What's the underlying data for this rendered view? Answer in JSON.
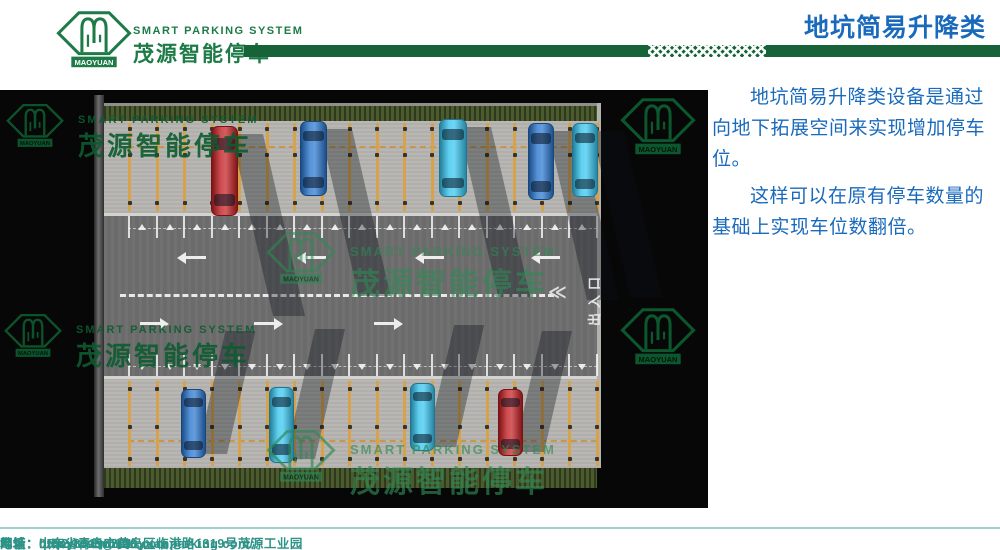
{
  "header": {
    "brand_logo_text": "MAOYUAN",
    "brand_en": "SMART PARKING SYSTEM",
    "brand_cn": "茂源智能停车",
    "title": "地坑简易升降类"
  },
  "colors": {
    "brand_green": "#1e7b48",
    "bar_green": "#166339",
    "title_blue": "#1a6abc",
    "footer_teal": "#2e9387",
    "watermark_on_black": "#0d5c31",
    "watermark_on_road": "#2e8a55"
  },
  "main": {
    "paragraphs": [
      "地坑简易升降类设备是通过向地下拓展空间来实现增加停车位。",
      "这样可以在原有停车数量的基础上实现车位数翻倍。"
    ]
  },
  "diagram": {
    "watermark_text": {
      "en": "SMART PARKING SYSTEM",
      "cn": "茂源智能停车",
      "brand": "MAOYUAN"
    },
    "exit": {
      "label": "出入口",
      "chevrons": "≪"
    },
    "slots": {
      "x_start": 128,
      "x_step": 27.5,
      "count": 18,
      "top_y": 33,
      "top_h": 88,
      "bottom_y": 291,
      "bottom_h": 85
    },
    "t_marks": {
      "top_line_y": 126,
      "bottom_line_y": 264,
      "line_h": 22,
      "top_rail_y": 138,
      "bottom_rail_y": 276
    },
    "arrows": {
      "top_y": 166,
      "bottom_y": 232,
      "top_dir": "left",
      "bottom_dir": "right",
      "top_x": [
        186,
        306,
        424,
        540
      ],
      "bottom_x": [
        140,
        254,
        374
      ]
    },
    "cars": [
      {
        "row": "top",
        "x": 211,
        "y": 36,
        "w": 27,
        "h": 90,
        "color": "#c32024"
      },
      {
        "row": "top",
        "x": 300,
        "y": 31,
        "w": 27,
        "h": 75,
        "color": "#2b77cf"
      },
      {
        "row": "top",
        "x": 439,
        "y": 29,
        "w": 28,
        "h": 78,
        "color": "#38c5ef"
      },
      {
        "row": "top",
        "x": 528,
        "y": 33,
        "w": 26,
        "h": 77,
        "color": "#2b77cf"
      },
      {
        "row": "top",
        "x": 572,
        "y": 33,
        "w": 26,
        "h": 74,
        "color": "#38c5ef"
      },
      {
        "row": "bottom",
        "x": 181,
        "y": 299,
        "w": 25,
        "h": 69,
        "color": "#2b77cf"
      },
      {
        "row": "bottom",
        "x": 269,
        "y": 297,
        "w": 25,
        "h": 76,
        "color": "#38c5ef"
      },
      {
        "row": "bottom",
        "x": 410,
        "y": 293,
        "w": 25,
        "h": 68,
        "color": "#38c5ef"
      },
      {
        "row": "bottom",
        "x": 498,
        "y": 299,
        "w": 25,
        "h": 67,
        "color": "#c32024"
      }
    ],
    "watermarks": [
      {
        "x": 6,
        "y": 12,
        "logo_w": 58,
        "texts": true,
        "en_size": 11,
        "cn_size": 26,
        "tone": "black",
        "opacity": 0.9
      },
      {
        "x": 4,
        "y": 222,
        "logo_w": 58,
        "texts": true,
        "en_size": 11,
        "cn_size": 26,
        "tone": "black",
        "opacity": 0.9
      },
      {
        "x": 266,
        "y": 140,
        "logo_w": 70,
        "texts": true,
        "en_size": 13,
        "cn_size": 30,
        "tone": "road",
        "opacity": 0.6
      },
      {
        "x": 266,
        "y": 338,
        "logo_w": 70,
        "texts": true,
        "en_size": 13,
        "cn_size": 30,
        "tone": "road",
        "opacity": 0.65
      },
      {
        "x": 620,
        "y": 6,
        "logo_w": 76,
        "texts": false,
        "tone": "black",
        "opacity": 0.95
      },
      {
        "x": 620,
        "y": 216,
        "logo_w": 76,
        "texts": false,
        "tone": "black",
        "opacity": 0.95
      }
    ]
  },
  "footer": {
    "items": [
      {
        "label": "地址：",
        "value": "山东省青岛市黄岛区临港路1319号茂源工业园"
      },
      {
        "label": "电话：",
        "value": "0532-83196261"
      },
      {
        "label": "邮箱：",
        "value": "qdmytcsb@126.com"
      },
      {
        "label": "网址：",
        "value": "http://www.maoyuanparking.com/"
      }
    ]
  }
}
